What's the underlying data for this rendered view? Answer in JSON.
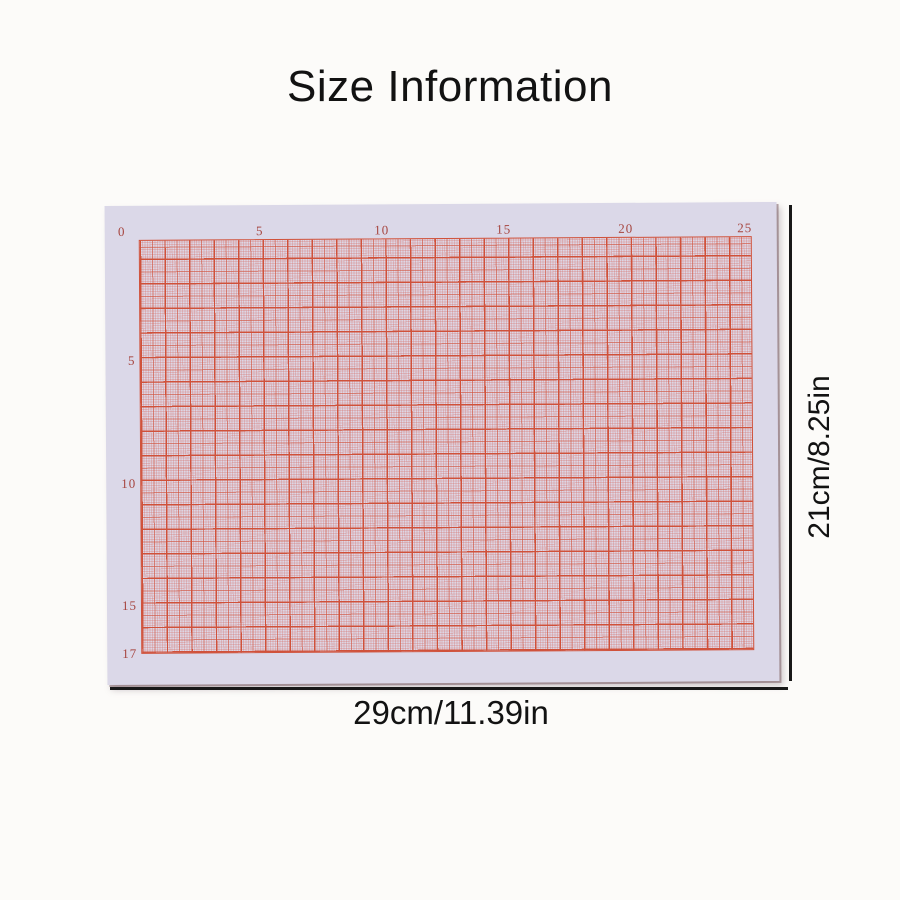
{
  "title": "Size Information",
  "graph_paper": {
    "description": "orange millimeter grid paper sheet",
    "top_ruler_labels": [
      "0",
      "5",
      "10",
      "15",
      "20",
      "25"
    ],
    "left_ruler_labels": [
      "5",
      "10",
      "15",
      "17"
    ]
  },
  "size_labels": {
    "width": "29cm/11.39in",
    "height": "21cm/8.25in"
  },
  "theme": {
    "page_bg": "#fcfbf9",
    "paper_bg": "#dbd8e8",
    "grid_field": "#ddd6e5",
    "grid_line": "#d0513a",
    "ruler_number": "#a6453f",
    "dimension_line": "#181818",
    "text": "#121212"
  }
}
